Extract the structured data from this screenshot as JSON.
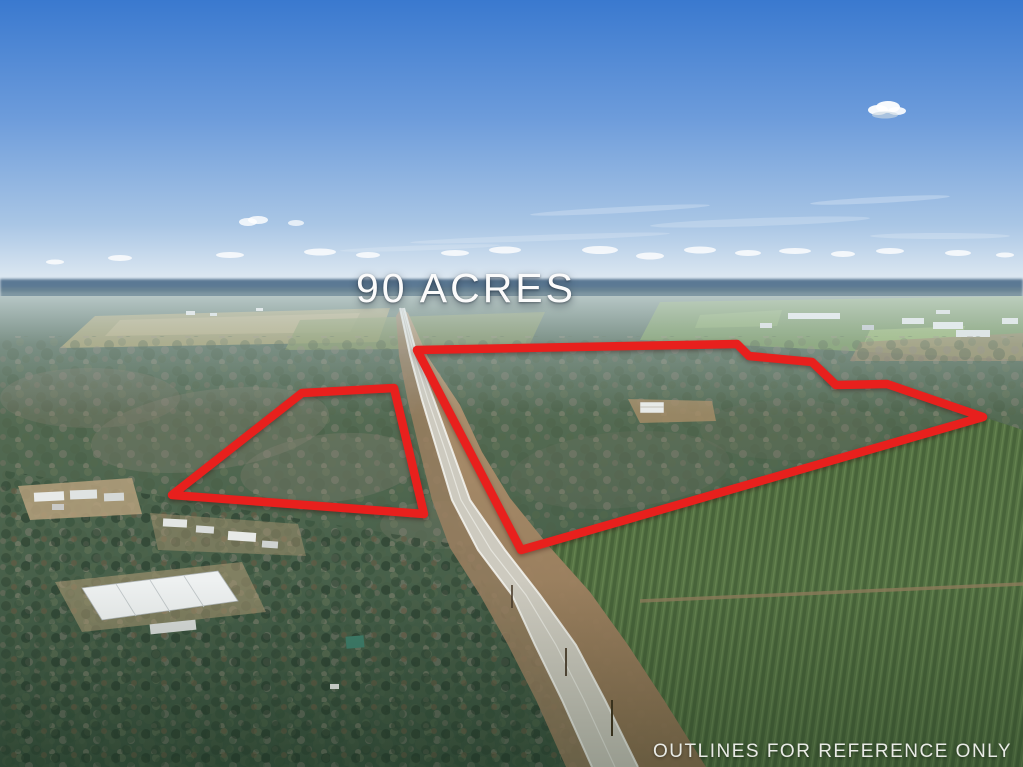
{
  "photo": {
    "acreage_label": "90 ACRES",
    "disclaimer": "OUTLINES FOR REFERENCE ONLY"
  },
  "colors": {
    "outline_red": "#e8201d",
    "sky_top": "#3a79cf",
    "sky_mid": "#6d9cdb",
    "sky_horizon": "#e8eff4",
    "label_white": "#fbfbfb",
    "disclaimer_white": "#e9ebe6",
    "road_pavement": "#cdcabf",
    "dirt_shoulder": "#a98a63",
    "plantation_green": "#5d7c4a",
    "forest_dark_green": "#3e5541",
    "distant_haze_blue": "#54718d"
  },
  "outlines": {
    "stroke_width": "8.5",
    "left_parcel_points": "302,393 394,388 424,514 172,495",
    "right_parcel_points": "417,350 737,344 749,356 812,362 836,385 887,384 983,417 521,550"
  }
}
